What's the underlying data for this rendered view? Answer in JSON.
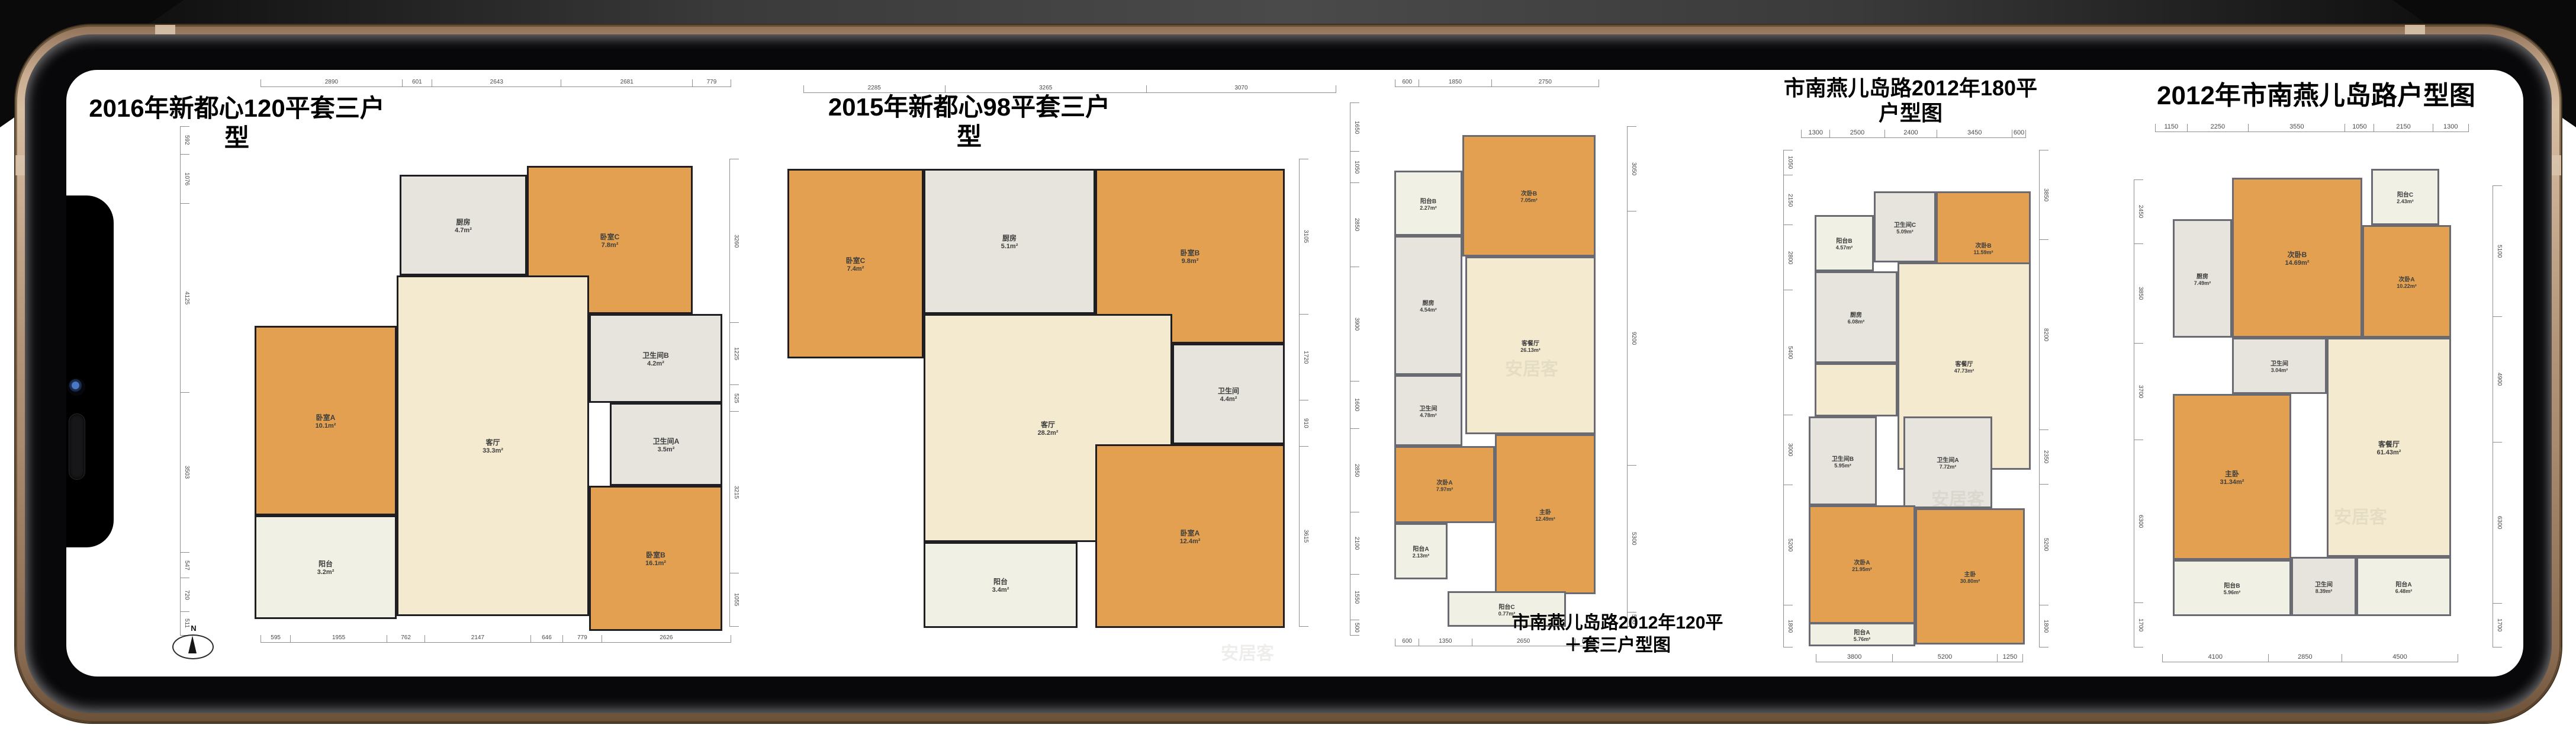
{
  "device": {
    "style": "gold-landscape-phone"
  },
  "watermark": "安居客",
  "compass": {
    "label": "N"
  },
  "plans": [
    {
      "title": "2016年新都心120平套三户型",
      "dims_top": [
        "2890",
        "601",
        "2643",
        "2681",
        "779"
      ],
      "dims_bottom": [
        "595",
        "1955",
        "762",
        "2147",
        "646",
        "779",
        "2626"
      ],
      "dims_left": [
        "592",
        "1076",
        "4125",
        "3503",
        "547",
        "720",
        "511"
      ],
      "dims_right": [
        "3260",
        "1225",
        "525",
        "3215",
        "1055"
      ],
      "rooms": [
        {
          "name": "厨房",
          "area": "4.7m²"
        },
        {
          "name": "卧室C",
          "area": "7.8m²"
        },
        {
          "name": "卫生间B",
          "area": "4.2m²"
        },
        {
          "name": "卫生间A",
          "area": "3.5m²"
        },
        {
          "name": "客厅",
          "area": "33.3m²"
        },
        {
          "name": "卧室A",
          "area": "10.1m²"
        },
        {
          "name": "阳台",
          "area": "3.2m²"
        },
        {
          "name": "卧室B",
          "area": "16.1m²"
        }
      ]
    },
    {
      "title": "2015年新都心98平套三户型",
      "dims_top": [
        "2285",
        "3265",
        "3070"
      ],
      "dims_right": [
        "3105",
        "1720",
        "910",
        "3615"
      ],
      "rooms": [
        {
          "name": "卧室C",
          "area": "7.4m²"
        },
        {
          "name": "厨房",
          "area": "5.1m²"
        },
        {
          "name": "卧室B",
          "area": "9.8m²"
        },
        {
          "name": "客厅",
          "area": "28.2m²"
        },
        {
          "name": "卫生间",
          "area": "4.4m²"
        },
        {
          "name": "卧室A",
          "area": "12.4m²"
        },
        {
          "name": "阳台",
          "area": "3.4m²"
        }
      ]
    },
    {
      "caption_line1": "市南燕儿岛路2012年120平",
      "caption_line2": "＋套三户型图",
      "dims_top": [
        "600",
        "1850",
        "2750"
      ],
      "dims_bottom": [
        "600",
        "1350",
        "2650",
        "600"
      ],
      "dims_left": [
        "1650",
        "1050",
        "2850",
        "3900",
        "1600",
        "2850",
        "2100",
        "1550",
        "500"
      ],
      "dims_right": [
        "3050",
        "9200",
        "5300",
        "500"
      ],
      "rooms": [
        {
          "name": "阳台B",
          "area": "2.27m²"
        },
        {
          "name": "次卧B",
          "area": "7.05m²"
        },
        {
          "name": "厨房",
          "area": "4.54m²"
        },
        {
          "name": "客餐厅",
          "area": "26.13m²"
        },
        {
          "name": "卫生间",
          "area": "4.78m²"
        },
        {
          "name": "次卧A",
          "area": "7.97m²"
        },
        {
          "name": "阳台A",
          "area": "2.13m²"
        },
        {
          "name": "主卧",
          "area": "12.49m²"
        },
        {
          "name": "阳台C",
          "area": "0.77m²"
        }
      ]
    },
    {
      "title": "市南燕儿岛路2012年180平户型图",
      "dims_top": [
        "1300",
        "2500",
        "2400",
        "3450",
        "600"
      ],
      "dims_bottom": [
        "3800",
        "5200",
        "1250"
      ],
      "dims_left": [
        "1050",
        "2150",
        "2800",
        "5400",
        "3000",
        "5200",
        "1800"
      ],
      "dims_right": [
        "3850",
        "8200",
        "2350",
        "5200",
        "1800"
      ],
      "rooms": [
        {
          "name": "阳台B",
          "area": "4.57m²"
        },
        {
          "name": "卫生间C",
          "area": "5.09m²"
        },
        {
          "name": "次卧B",
          "area": "11.59m²"
        },
        {
          "name": "厨房",
          "area": "6.08m²"
        },
        {
          "name": "客餐厅",
          "area": "47.73m²"
        },
        {
          "name": "卫生间B",
          "area": "5.95m²"
        },
        {
          "name": "卫生间A",
          "area": "7.72m²"
        },
        {
          "name": "次卧A",
          "area": "21.95m²"
        },
        {
          "name": "主卧",
          "area": "30.80m²"
        },
        {
          "name": "阳台A",
          "area": "5.76m²"
        }
      ]
    },
    {
      "title": "2012年市南燕儿岛路户型图",
      "dims_top": [
        "1150",
        "2250",
        "3550",
        "1050",
        "2150",
        "1300"
      ],
      "dims_bottom": [
        "4100",
        "2850",
        "4500"
      ],
      "dims_left": [
        "2450",
        "3850",
        "3700",
        "6300",
        "1700"
      ],
      "dims_right": [
        "5100",
        "4900",
        "6300",
        "1700"
      ],
      "rooms": [
        {
          "name": "次卧B",
          "area": "14.69m²"
        },
        {
          "name": "阳台C",
          "area": "2.43m²"
        },
        {
          "name": "次卧A",
          "area": "10.22m²"
        },
        {
          "name": "厨房",
          "area": "7.49m²"
        },
        {
          "name": "卫生间",
          "area": "3.04m²"
        },
        {
          "name": "客餐厅",
          "area": "61.43m²"
        },
        {
          "name": "主卧",
          "area": "31.34m²"
        },
        {
          "name": "卫生间",
          "area": "8.39m²"
        },
        {
          "name": "阳台B",
          "area": "5.96m²"
        },
        {
          "name": "阳台A",
          "area": "6.48m²"
        }
      ]
    }
  ]
}
